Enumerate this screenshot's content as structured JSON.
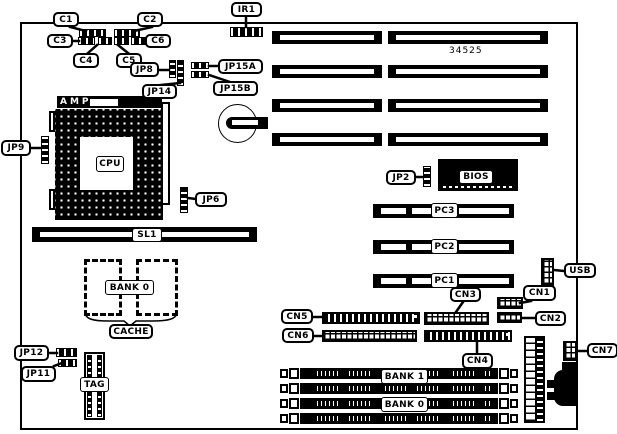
{
  "colors": {
    "ink": "#000000",
    "paper": "#ffffff"
  },
  "board": {
    "part_number": "34525"
  },
  "labels": {
    "c1": "C1",
    "c2": "C2",
    "c3": "C3",
    "c4": "C4",
    "c5": "C5",
    "c6": "C6",
    "ir1": "IR1",
    "jp2": "JP2",
    "jp6": "JP6",
    "jp8": "JP8",
    "jp9": "JP9",
    "jp11": "JP11",
    "jp12": "JP12",
    "jp14": "JP14",
    "jp15a": "JP15A",
    "jp15b": "JP15B",
    "amp": "AMP",
    "cpu": "CPU",
    "bios": "BIOS",
    "sl1": "SL1",
    "pc1": "PC1",
    "pc2": "PC2",
    "pc3": "PC3",
    "cache_bank": "BANK 0",
    "cache": "CACHE",
    "tag": "TAG",
    "cn1": "CN1",
    "cn2": "CN2",
    "cn3": "CN3",
    "cn4": "CN4",
    "cn5": "CN5",
    "cn6": "CN6",
    "cn7": "CN7",
    "usb": "USB",
    "bank1": "BANK 1",
    "bank0": "BANK 0"
  }
}
